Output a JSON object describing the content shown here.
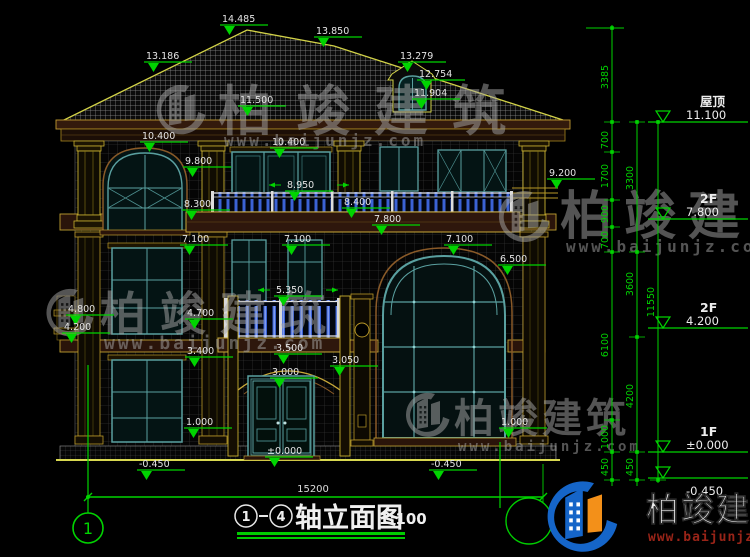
{
  "drawing": {
    "title": {
      "axis_from": "1",
      "axis_to": "4",
      "name": "轴立面图",
      "scale": "1:100"
    },
    "axis_bubble_left": "1",
    "ground_dimension": "15200"
  },
  "elevation_markers": [
    {
      "label": "14.485",
      "x": 222,
      "y": 13
    },
    {
      "label": "13.850",
      "x": 316,
      "y": 25
    },
    {
      "label": "13.186",
      "x": 146,
      "y": 50
    },
    {
      "label": "13.279",
      "x": 400,
      "y": 50
    },
    {
      "label": "12.754",
      "x": 419,
      "y": 68
    },
    {
      "label": "11.904",
      "x": 414,
      "y": 87
    },
    {
      "label": "11.500",
      "x": 240,
      "y": 94
    },
    {
      "label": "10.400",
      "x": 142,
      "y": 130
    },
    {
      "label": "10.400",
      "x": 272,
      "y": 136
    },
    {
      "label": "9.800",
      "x": 185,
      "y": 155
    },
    {
      "label": "9.200",
      "x": 549,
      "y": 167
    },
    {
      "label": "8.950",
      "x": 287,
      "y": 179,
      "arrows": true
    },
    {
      "label": "8.300",
      "x": 184,
      "y": 198
    },
    {
      "label": "8.400",
      "x": 344,
      "y": 196
    },
    {
      "label": "7.800",
      "x": 374,
      "y": 213
    },
    {
      "label": "7.100",
      "x": 182,
      "y": 233
    },
    {
      "label": "7.100",
      "x": 284,
      "y": 233
    },
    {
      "label": "7.100",
      "x": 446,
      "y": 233
    },
    {
      "label": "6.500",
      "x": 500,
      "y": 253
    },
    {
      "label": "5.350",
      "x": 276,
      "y": 284,
      "arrows": true
    },
    {
      "label": "4.800",
      "x": 68,
      "y": 303
    },
    {
      "label": "4.200",
      "x": 64,
      "y": 321
    },
    {
      "label": "4.700",
      "x": 187,
      "y": 307
    },
    {
      "label": "3.400",
      "x": 187,
      "y": 345
    },
    {
      "label": "3.500",
      "x": 276,
      "y": 342
    },
    {
      "label": "3.050",
      "x": 332,
      "y": 354
    },
    {
      "label": "3.000",
      "x": 272,
      "y": 366
    },
    {
      "label": "1.000",
      "x": 186,
      "y": 416
    },
    {
      "label": "1.000",
      "x": 501,
      "y": 416
    },
    {
      "label": "±0.000",
      "x": 267,
      "y": 445
    },
    {
      "label": "-0.450",
      "x": 139,
      "y": 458
    },
    {
      "label": "-0.450",
      "x": 431,
      "y": 458
    }
  ],
  "dimension_chains": [
    {
      "x": 612,
      "y1": 25,
      "y2": 486,
      "ticks": [
        28,
        122,
        152,
        200,
        227,
        252,
        420,
        452,
        480
      ],
      "labels": [
        {
          "t": "3385",
          "y": 77
        },
        {
          "t": "700",
          "y": 140
        },
        {
          "t": "1700",
          "y": 176
        },
        {
          "t": "900",
          "y": 214
        },
        {
          "t": "700",
          "y": 240
        },
        {
          "t": "6100",
          "y": 345
        },
        {
          "t": "1000",
          "y": 437
        },
        {
          "t": "450",
          "y": 467
        }
      ]
    },
    {
      "x": 637,
      "y1": 120,
      "y2": 486,
      "ticks": [
        122,
        252,
        337,
        452,
        480
      ],
      "labels": [
        {
          "t": "3300",
          "y": 178
        },
        {
          "t": "3600",
          "y": 284
        },
        {
          "t": "4200",
          "y": 396
        },
        {
          "t": "450",
          "y": 467
        }
      ]
    },
    {
      "x": 658,
      "y1": 120,
      "y2": 483,
      "ticks": [
        122,
        480
      ],
      "labels": [
        {
          "t": "11550",
          "y": 302
        }
      ]
    }
  ],
  "level_markers": [
    {
      "name": "屋顶",
      "elevation": "11.100",
      "y": 122
    },
    {
      "name": "2F",
      "elevation": "7.800",
      "y": 219
    },
    {
      "name": "2F",
      "elevation": "4.200",
      "y": 328
    },
    {
      "name": "1F",
      "elevation": "±0.000",
      "y": 452
    },
    {
      "name": "",
      "elevation": "-0.450",
      "y": 478
    }
  ],
  "watermark": {
    "brand": "柏竣建筑",
    "url": "www.baijunjz.com",
    "gray_instances": [
      {
        "lx": 150,
        "ly": 84,
        "ls": 56,
        "tx": 218,
        "ty": 130,
        "tf": 54,
        "sp": 24,
        "ux": 224,
        "uy": 146,
        "uf": 16
      },
      {
        "lx": 492,
        "ly": 190,
        "ls": 58,
        "tx": 560,
        "ty": 234,
        "tf": 52,
        "sp": 12,
        "ux": 566,
        "uy": 252,
        "uf": 16
      },
      {
        "lx": 40,
        "ly": 288,
        "ls": 54,
        "tx": 100,
        "ty": 330,
        "tf": 46,
        "sp": 14,
        "ux": 104,
        "uy": 349,
        "uf": 18
      },
      {
        "lx": 400,
        "ly": 392,
        "ls": 50,
        "tx": 454,
        "ty": 432,
        "tf": 40,
        "sp": 4,
        "ux": 458,
        "uy": 451,
        "uf": 14
      }
    ],
    "colored": {
      "lx": 538,
      "ly": 480,
      "ls": 80,
      "tx": 646,
      "ty": 521,
      "tf": 33,
      "sp": 2,
      "ux": 648,
      "uy": 541,
      "uf": 13
    }
  },
  "colors": {
    "background": "#000000",
    "dimension_green": "#00d400",
    "annotation_white": "#e4e4e4",
    "outline_yellow": "#c8b030",
    "roof_line": "#d2d248",
    "window_teal": "#5aa0a0",
    "baluster_blue": "#3b62d6",
    "band_brown": "#2e170c",
    "watermark_gray": "#a8a8a8",
    "logo_blue": "#1565c8",
    "logo_orange": "#f39019",
    "url_red": "#992418"
  }
}
